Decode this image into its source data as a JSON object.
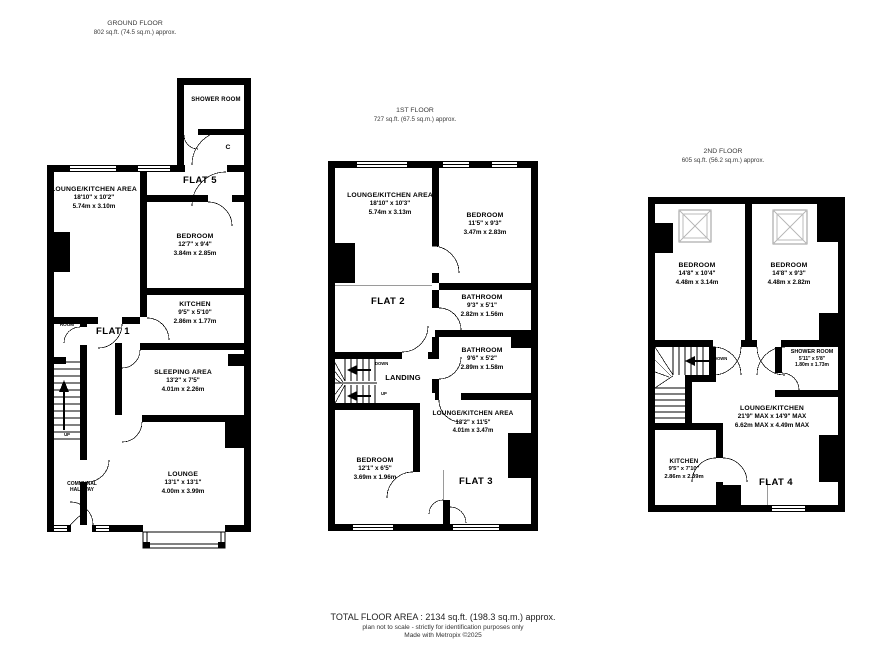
{
  "floors": [
    {
      "title": "GROUND FLOOR",
      "area": "802 sq.ft. (74.5 sq.m.) approx.",
      "rooms": [
        {
          "name": "SHOWER ROOM"
        },
        {
          "name": "C"
        },
        {
          "name": "FLAT 5"
        },
        {
          "name": "LOUNGE/KITCHEN AREA",
          "imperial": "18'10\"  x 10'2\"",
          "metric": "5.74m  x 3.10m"
        },
        {
          "name": "BEDROOM",
          "imperial": "12'7\"  x 9'4\"",
          "metric": "3.84m  x 2.85m"
        },
        {
          "name": "KITCHEN",
          "imperial": "9'5\"  x 5'10\"",
          "metric": "2.86m  x 1.77m"
        },
        {
          "name": "SHOWER ROOM"
        },
        {
          "name": "FLAT 1"
        },
        {
          "name": "SLEEPING AREA",
          "imperial": "13'2\"  x 7'5\"",
          "metric": "4.01m  x 2.26m"
        },
        {
          "name": "LOUNGE",
          "imperial": "13'1\"  x 13'1\"",
          "metric": "4.00m  x 3.99m"
        },
        {
          "name": "COMMUNAL HALLWAY"
        },
        {
          "name": "UP"
        }
      ]
    },
    {
      "title": "1ST FLOOR",
      "area": "727 sq.ft. (67.5 sq.m.) approx.",
      "rooms": [
        {
          "name": "LOUNGE/KITCHEN AREA",
          "imperial": "18'10\"  x 10'3\"",
          "metric": "5.74m  x 3.13m"
        },
        {
          "name": "BEDROOM",
          "imperial": "11'5\"  x 9'3\"",
          "metric": "3.47m  x 2.83m"
        },
        {
          "name": "FLAT 2"
        },
        {
          "name": "BATHROOM",
          "imperial": "9'3\"  x 5'1\"",
          "metric": "2.82m  x 1.56m"
        },
        {
          "name": "BATHROOM",
          "imperial": "9'6\"  x 5'2\"",
          "metric": "2.89m  x 1.58m"
        },
        {
          "name": "LANDING"
        },
        {
          "name": "DOWN"
        },
        {
          "name": "UP"
        },
        {
          "name": "LOUNGE/KITCHEN AREA",
          "imperial": "13'2\"  x 11'5\"",
          "metric": "4.01m  x 3.47m"
        },
        {
          "name": "BEDROOM",
          "imperial": "12'1\"  x 6'5\"",
          "metric": "3.69m  x 1.96m"
        },
        {
          "name": "FLAT 3"
        }
      ]
    },
    {
      "title": "2ND FLOOR",
      "area": "605 sq.ft. (56.2 sq.m.) approx.",
      "rooms": [
        {
          "name": "BEDROOM",
          "imperial": "14'8\"  x 10'4\"",
          "metric": "4.48m  x 3.14m"
        },
        {
          "name": "BEDROOM",
          "imperial": "14'8\"  x 9'3\"",
          "metric": "4.48m  x 2.82m"
        },
        {
          "name": "SHOWER ROOM",
          "imperial": "5'11\"  x 5'8\"",
          "metric": "1.80m  x 1.73m"
        },
        {
          "name": "LOUNGE/KITCHEN",
          "imperial": "21'9\" MAX x 14'9\" MAX",
          "metric": "6.62m MAX x 4.49m MAX"
        },
        {
          "name": "KITCHEN",
          "imperial": "9'5\"  x 7'10\"",
          "metric": "2.86m  x 2.39m"
        },
        {
          "name": "FLAT 4"
        },
        {
          "name": "DOWN"
        }
      ]
    }
  ],
  "footer": {
    "total": "TOTAL FLOOR AREA : 2134 sq.ft. (198.3 sq.m.) approx.",
    "disclaimer": "plan not to scale - strictly for identification purposes only",
    "credit": "Made with Metropix ©2025"
  }
}
